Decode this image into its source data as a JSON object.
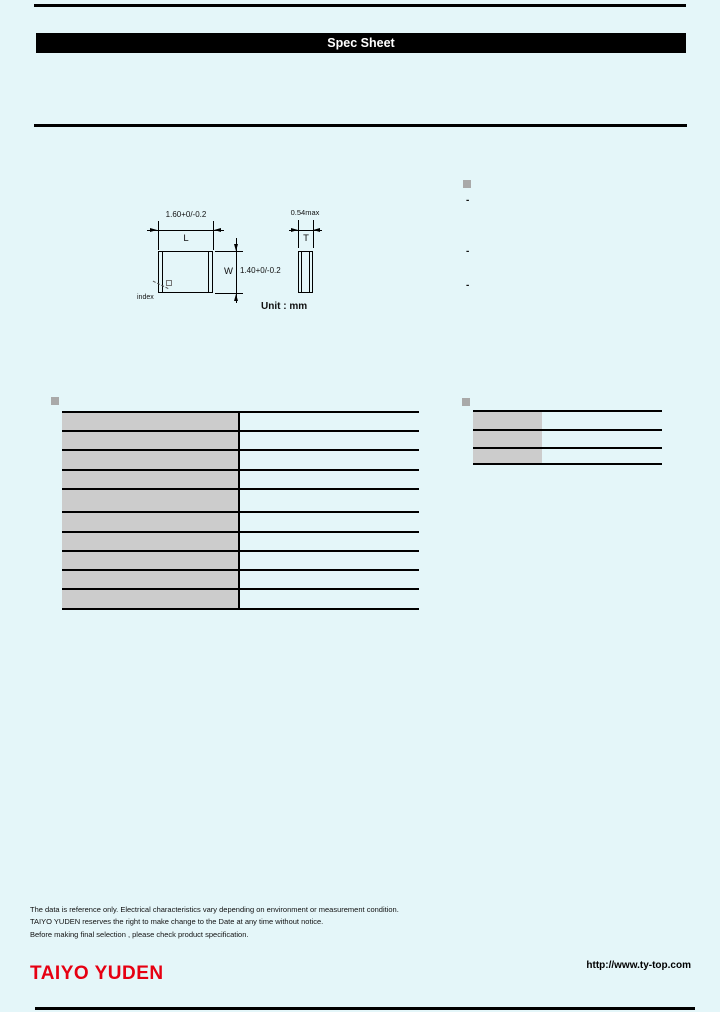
{
  "colors": {
    "background": "#e4f6f9",
    "table_fill_gray": "#cccccc",
    "section_bullet_gray": "#a9a9a9",
    "logo_red": "#e60012"
  },
  "header": {
    "title": "Spec Sheet"
  },
  "drawing": {
    "length_dim": "1.60+0/-0.2",
    "length_label": "L",
    "width_dim": "1.40+0/-0.2",
    "width_label": "W",
    "thickness_dim": "0.54max",
    "thickness_label": "T",
    "index_label": "index",
    "unit": "Unit : mm"
  },
  "right_list": {
    "items": [
      "-",
      "-",
      "-"
    ]
  },
  "tables": {
    "left_table_rows": 10,
    "right_table_rows": 3,
    "cells_text": []
  },
  "notes": [
    "The data is reference only. Electrical characteristics vary depending on environment or measurement condition.",
    "TAIYO YUDEN reserves the right to make change to the Date at any time without notice.",
    "Before making final selection , please check product specification."
  ],
  "footer": {
    "logo": "TAIYO YUDEN",
    "url": "http://www.ty-top.com"
  }
}
